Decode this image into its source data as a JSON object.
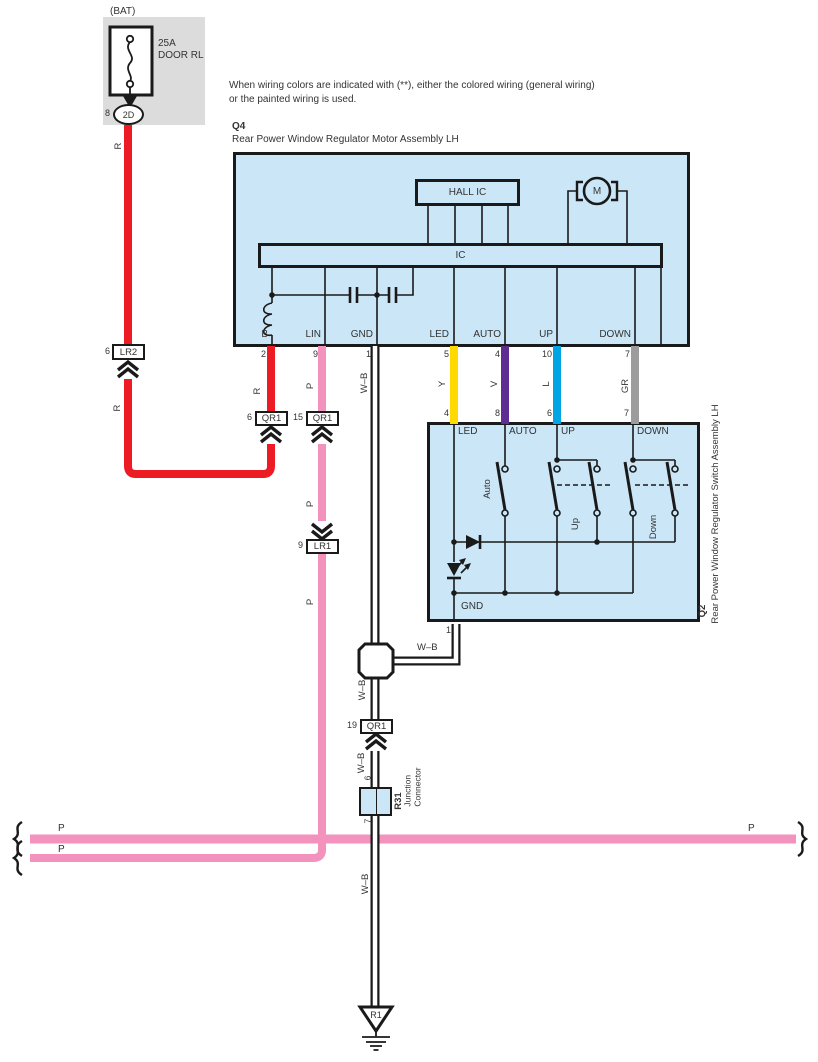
{
  "note": {
    "line1": "When wiring colors are indicated with (**),  either the colored wiring (general wiring)",
    "line2": "or the painted wiring is used."
  },
  "battery": {
    "label": "(BAT)",
    "fuse_rating": "25A",
    "fuse_name": "DOOR RL",
    "pin": "8",
    "connector": "2D"
  },
  "q4": {
    "id": "Q4",
    "name": "Rear Power Window Regulator Motor Assembly LH",
    "hall_ic": "HALL IC",
    "ic": "IC",
    "motor": "M",
    "pins": [
      {
        "label": "B",
        "number": "2"
      },
      {
        "label": "LIN",
        "number": "9"
      },
      {
        "label": "GND",
        "number": "1"
      },
      {
        "label": "LED",
        "number": "5"
      },
      {
        "label": "AUTO",
        "number": "4"
      },
      {
        "label": "UP",
        "number": "10"
      },
      {
        "label": "DOWN",
        "number": "7"
      }
    ]
  },
  "q2": {
    "id": "Q2",
    "name": "Rear Power Window Regulator Switch Assembly LH",
    "pins_top": [
      {
        "label": "LED",
        "number": "4"
      },
      {
        "label": "AUTO",
        "number": "8"
      },
      {
        "label": "UP",
        "number": "6"
      },
      {
        "label": "DOWN",
        "number": "7"
      }
    ],
    "switch_auto": "Auto",
    "switch_up": "Up",
    "switch_down": "Down",
    "gnd_label": "GND",
    "gnd_pin": "1"
  },
  "connectors": {
    "lr2": {
      "pin": "6",
      "name": "LR2"
    },
    "qr1_b": {
      "pin": "6",
      "name": "QR1"
    },
    "qr1_lin": {
      "pin": "15",
      "name": "QR1"
    },
    "lr1": {
      "pin": "9",
      "name": "LR1"
    },
    "qr1_gnd": {
      "pin": "19",
      "name": "QR1"
    },
    "r31": {
      "id": "R31",
      "desc_line1": "Junction",
      "desc_line2": "Connector",
      "pin_top": "6",
      "pin_bottom": "7"
    }
  },
  "ground": {
    "id": "R1"
  },
  "wire_labels": {
    "r": "R",
    "p": "P",
    "wb": "W–B",
    "y": "Y",
    "v": "V",
    "l": "L",
    "gr": "GR"
  },
  "colors": {
    "red": "#ED1C24",
    "pink": "#F492BE",
    "yellow": "#FFD900",
    "violet": "#5E2D91",
    "light_blue": "#00A6E4",
    "gray": "#9C9C9C",
    "component_fill": "#CBE7F7",
    "fuse_bg": "#DCDCDC"
  }
}
